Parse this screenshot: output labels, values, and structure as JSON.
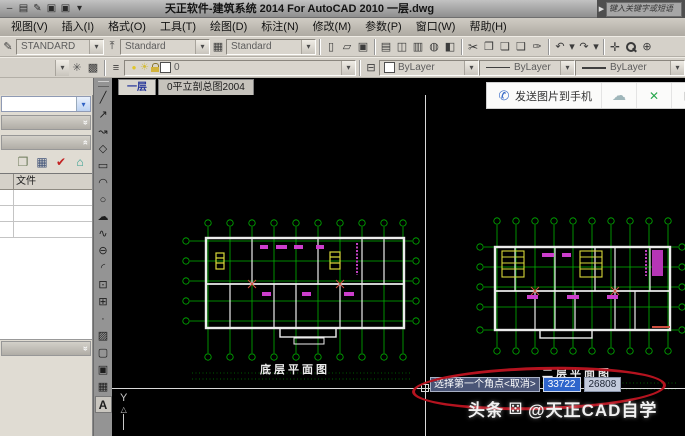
{
  "title_bar": {
    "title": "天正软件-建筑系统 2014  For AutoCAD 2010  一层.dwg",
    "search_placeholder": "键入关键字或短语",
    "qat_icons": [
      "minus-icon",
      "print-icon",
      "pencil-icon",
      "save-icon",
      "saveas-icon",
      "dropdown-icon"
    ]
  },
  "menu": {
    "items": [
      "视图(V)",
      "插入(I)",
      "格式(O)",
      "工具(T)",
      "绘图(D)",
      "标注(N)",
      "修改(M)",
      "参数(P)",
      "窗口(W)",
      "帮助(H)"
    ]
  },
  "toolbar_styles": {
    "combos": [
      {
        "name": "text-style-combo",
        "icon": "text-style-icon",
        "value": "STANDARD"
      },
      {
        "name": "dim-style-combo",
        "icon": "dim-style-icon",
        "value": "Standard"
      },
      {
        "name": "table-style-combo",
        "icon": "table-style-icon",
        "value": "Standard"
      }
    ]
  },
  "toolbar_standard": {
    "icons": [
      "new-icon",
      "open-icon",
      "save-icon",
      "|",
      "print-icon",
      "preview-icon",
      "plot-icon",
      "publish-icon",
      "layout-icon",
      "|",
      "cut-icon",
      "copy-icon",
      "paste-icon",
      "paste-special-icon",
      "match-properties-icon",
      "|",
      "undo-icon",
      "dropdown-icon",
      "redo-icon",
      "dropdown-icon",
      "|",
      "pan-icon",
      "zoom-icon",
      "zoom-window-icon"
    ]
  },
  "toolbar_properties": {
    "left_icons": [
      "gear-icon",
      "render-icon"
    ],
    "layers_icon": "layers-icon",
    "layer_name": "0",
    "match_icon": "make-current-icon",
    "color_label": "ByLayer",
    "linetype_label": "ByLayer",
    "lineweight_label": "ByLayer"
  },
  "doc_tabs": {
    "items": [
      {
        "label": "一层",
        "active": true
      },
      {
        "label": "0平立剖总图2004",
        "active": false
      }
    ]
  },
  "float_toolbar": {
    "send_button": "发送图片到手机",
    "icons": [
      "cloud-icon",
      "fullscreen-icon",
      "qr-icon"
    ]
  },
  "left_panel": {
    "toolbar_icons": [
      "copy-project-icon",
      "sheet-set-icon",
      "sync-check-icon",
      "building-icon"
    ],
    "table": {
      "header": "文件",
      "rows": [
        "",
        "",
        ""
      ]
    }
  },
  "draw_toolbar": {
    "tools": [
      "line-icon",
      "xline-icon",
      "polyline-icon",
      "polygon-icon",
      "rectangle-icon",
      "arc-icon",
      "circle-icon",
      "revcloud-icon",
      "spline-icon",
      "ellipse-icon",
      "ellipse-arc-icon",
      "insert-block-icon",
      "make-block-icon",
      "point-icon",
      "hatch-icon",
      "boundary-icon",
      "image-icon",
      "table-icon",
      "text-icon"
    ]
  },
  "canvas": {
    "plans": {
      "left_label": "底层平面图",
      "right_label": "二层平面图"
    },
    "prompt": {
      "text": "选择第一个角点<取消>",
      "x": "33722",
      "y": "26808"
    },
    "watermark": {
      "prefix": "头条",
      "suffix": "@天正CAD自学"
    },
    "ucs": {
      "label": "Y"
    }
  },
  "icon_glyphs": {
    "minus-icon": "–",
    "print-icon": "▤",
    "pencil-icon": "✎",
    "save-icon": "▣",
    "saveas-icon": "▣",
    "dropdown-icon": "▾",
    "search-arrow-icon": "▶",
    "combo-chevron-icon": "▾",
    "rollup-down-icon": "»",
    "rollup-up-icon": "«",
    "panel-chevron-icon": "▾",
    "text-style-icon": "✎",
    "dim-style-icon": "⤒",
    "table-style-icon": "▦",
    "new-icon": "▯",
    "open-icon": "▱",
    "preview-icon": "◫",
    "plot-icon": "▥",
    "publish-icon": "◍",
    "layout-icon": "◧",
    "cut-icon": "✂",
    "copy-icon": "❐",
    "paste-icon": "❏",
    "paste-special-icon": "❑",
    "match-properties-icon": "✑",
    "undo-icon": "↶",
    "redo-icon": "↷",
    "pan-icon": "✛",
    "zoom-icon": "",
    "zoom-window-icon": "⊕",
    "gear-icon": "✳",
    "render-icon": "▩",
    "layers-icon": "≡",
    "make-current-icon": "⊟",
    "bulb-icon": "●",
    "sun-icon": "☀",
    "lock-icon": "",
    "phone-icon": "✆",
    "cloud-icon": "☁",
    "fullscreen-icon": "✕",
    "qr-icon": "▦",
    "copy-project-icon": "❐",
    "sheet-set-icon": "▦",
    "sync-check-icon": "✔",
    "building-icon": "⌂",
    "line-icon": "╱",
    "xline-icon": "↗",
    "polyline-icon": "↝",
    "polygon-icon": "◇",
    "rectangle-icon": "▭",
    "arc-icon": "◠",
    "circle-icon": "○",
    "revcloud-icon": "☁",
    "spline-icon": "∿",
    "ellipse-icon": "⊖",
    "ellipse-arc-icon": "◜",
    "insert-block-icon": "⊡",
    "make-block-icon": "⊞",
    "point-icon": "·",
    "hatch-icon": "▨",
    "boundary-icon": "▢",
    "image-icon": "▣",
    "table-icon": "▦",
    "text-icon": "A",
    "dice-icon": "⚄"
  },
  "colors": {
    "grid_green": "#00b400",
    "wall_white": "#ececec",
    "magenta": "#cc3ecc",
    "door_yellow": "#d8d838",
    "annotation_red": "#b5131f",
    "selection_blue": "#2f66cc",
    "canvas_black": "#000000"
  }
}
